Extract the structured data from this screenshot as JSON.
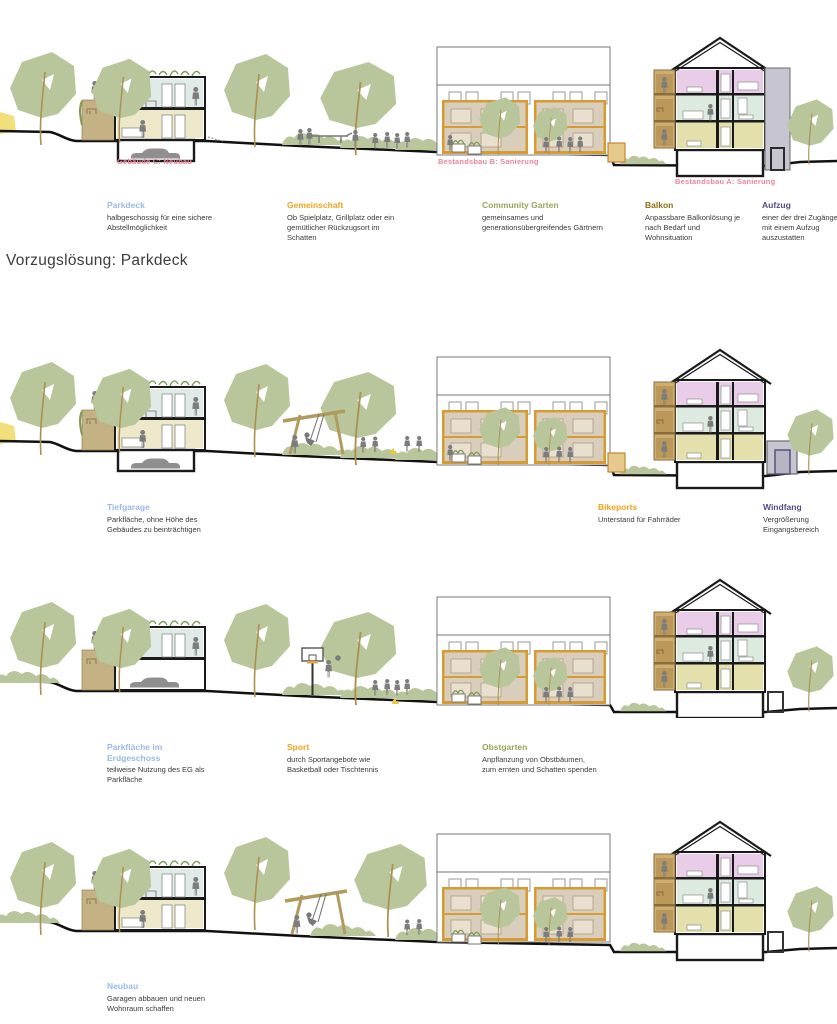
{
  "title": "Vorzugslösung: Parkdeck",
  "colors": {
    "heading_blue": "#9bb8e8",
    "heading_orange": "#f6a21c",
    "heading_olive": "#9aa55c",
    "heading_gold": "#8f6c0e",
    "heading_purple": "#584a87",
    "label_pink": "#f0849b",
    "tree_green": "#b9c69c",
    "ground_black": "#111111"
  },
  "building_labels": {
    "color": "#f0849b",
    "gebaeude_c": "Gebäude C: Neubau",
    "bestandsbau_b": "Bestandsbau B: Sanierung",
    "bestandsbau_a": "Bestandsbau A: Sanierung"
  },
  "sections": [
    {
      "name": "Parkdeck",
      "annotations": [
        {
          "heading": "Parkdeck",
          "color": "#9bb8e8",
          "body": "halbgeschossig für eine sichere Abstellmöglichkeit"
        },
        {
          "heading": "Gemeinschaft",
          "color": "#f6a21c",
          "body": "Ob Spielplatz, Grillplatz oder ein gemütlicher Rückzugsort im Schatten"
        },
        {
          "heading": "Community Garten",
          "color": "#9aa55c",
          "body": "gemeinsames und generationsübergreifendes Gärtnern"
        },
        {
          "heading": "Balkon",
          "color": "#8f6c0e",
          "body": "Anpassbare Balkonlösung je nach Bedarf und Wohnsituation"
        },
        {
          "heading": "Aufzug",
          "color": "#584a87",
          "body": "einer der drei Zugänge ist mit einem Aufzug auszustatten"
        }
      ]
    },
    {
      "name": "Tiefgarage",
      "annotations": [
        {
          "heading": "Tiefgarage",
          "color": "#9bb8e8",
          "body": "Parkfläche, ohne Höhe des Gebäudes zu beinträchtigen"
        },
        {
          "heading": "Bikeports",
          "color": "#f6a21c",
          "body": "Unterstand für Fahrräder"
        },
        {
          "heading": "Windfang",
          "color": "#584a87",
          "body": "Vergrößerung Eingangsbereich"
        }
      ]
    },
    {
      "name": "Parkflaeche im Erdgeschoss",
      "annotations": [
        {
          "heading": "Parkfläche im Erdgeschoss",
          "color": "#9bb8e8",
          "body": "teilweise Nutzung des EG als Parkfläche"
        },
        {
          "heading": "Sport",
          "color": "#f6a21c",
          "body": "durch Sportangebote wie Basketball oder Tischtennis"
        },
        {
          "heading": "Obstgarten",
          "color": "#9aa55c",
          "body": "Anpflanzung von Obstbäumen, zum ernten und Schatten spenden"
        }
      ]
    },
    {
      "name": "Neubau",
      "annotations": [
        {
          "heading": "Neubau",
          "color": "#9bb8e8",
          "body": "Garagen abbauen und neuen Wohnraum schaffen"
        }
      ]
    }
  ]
}
